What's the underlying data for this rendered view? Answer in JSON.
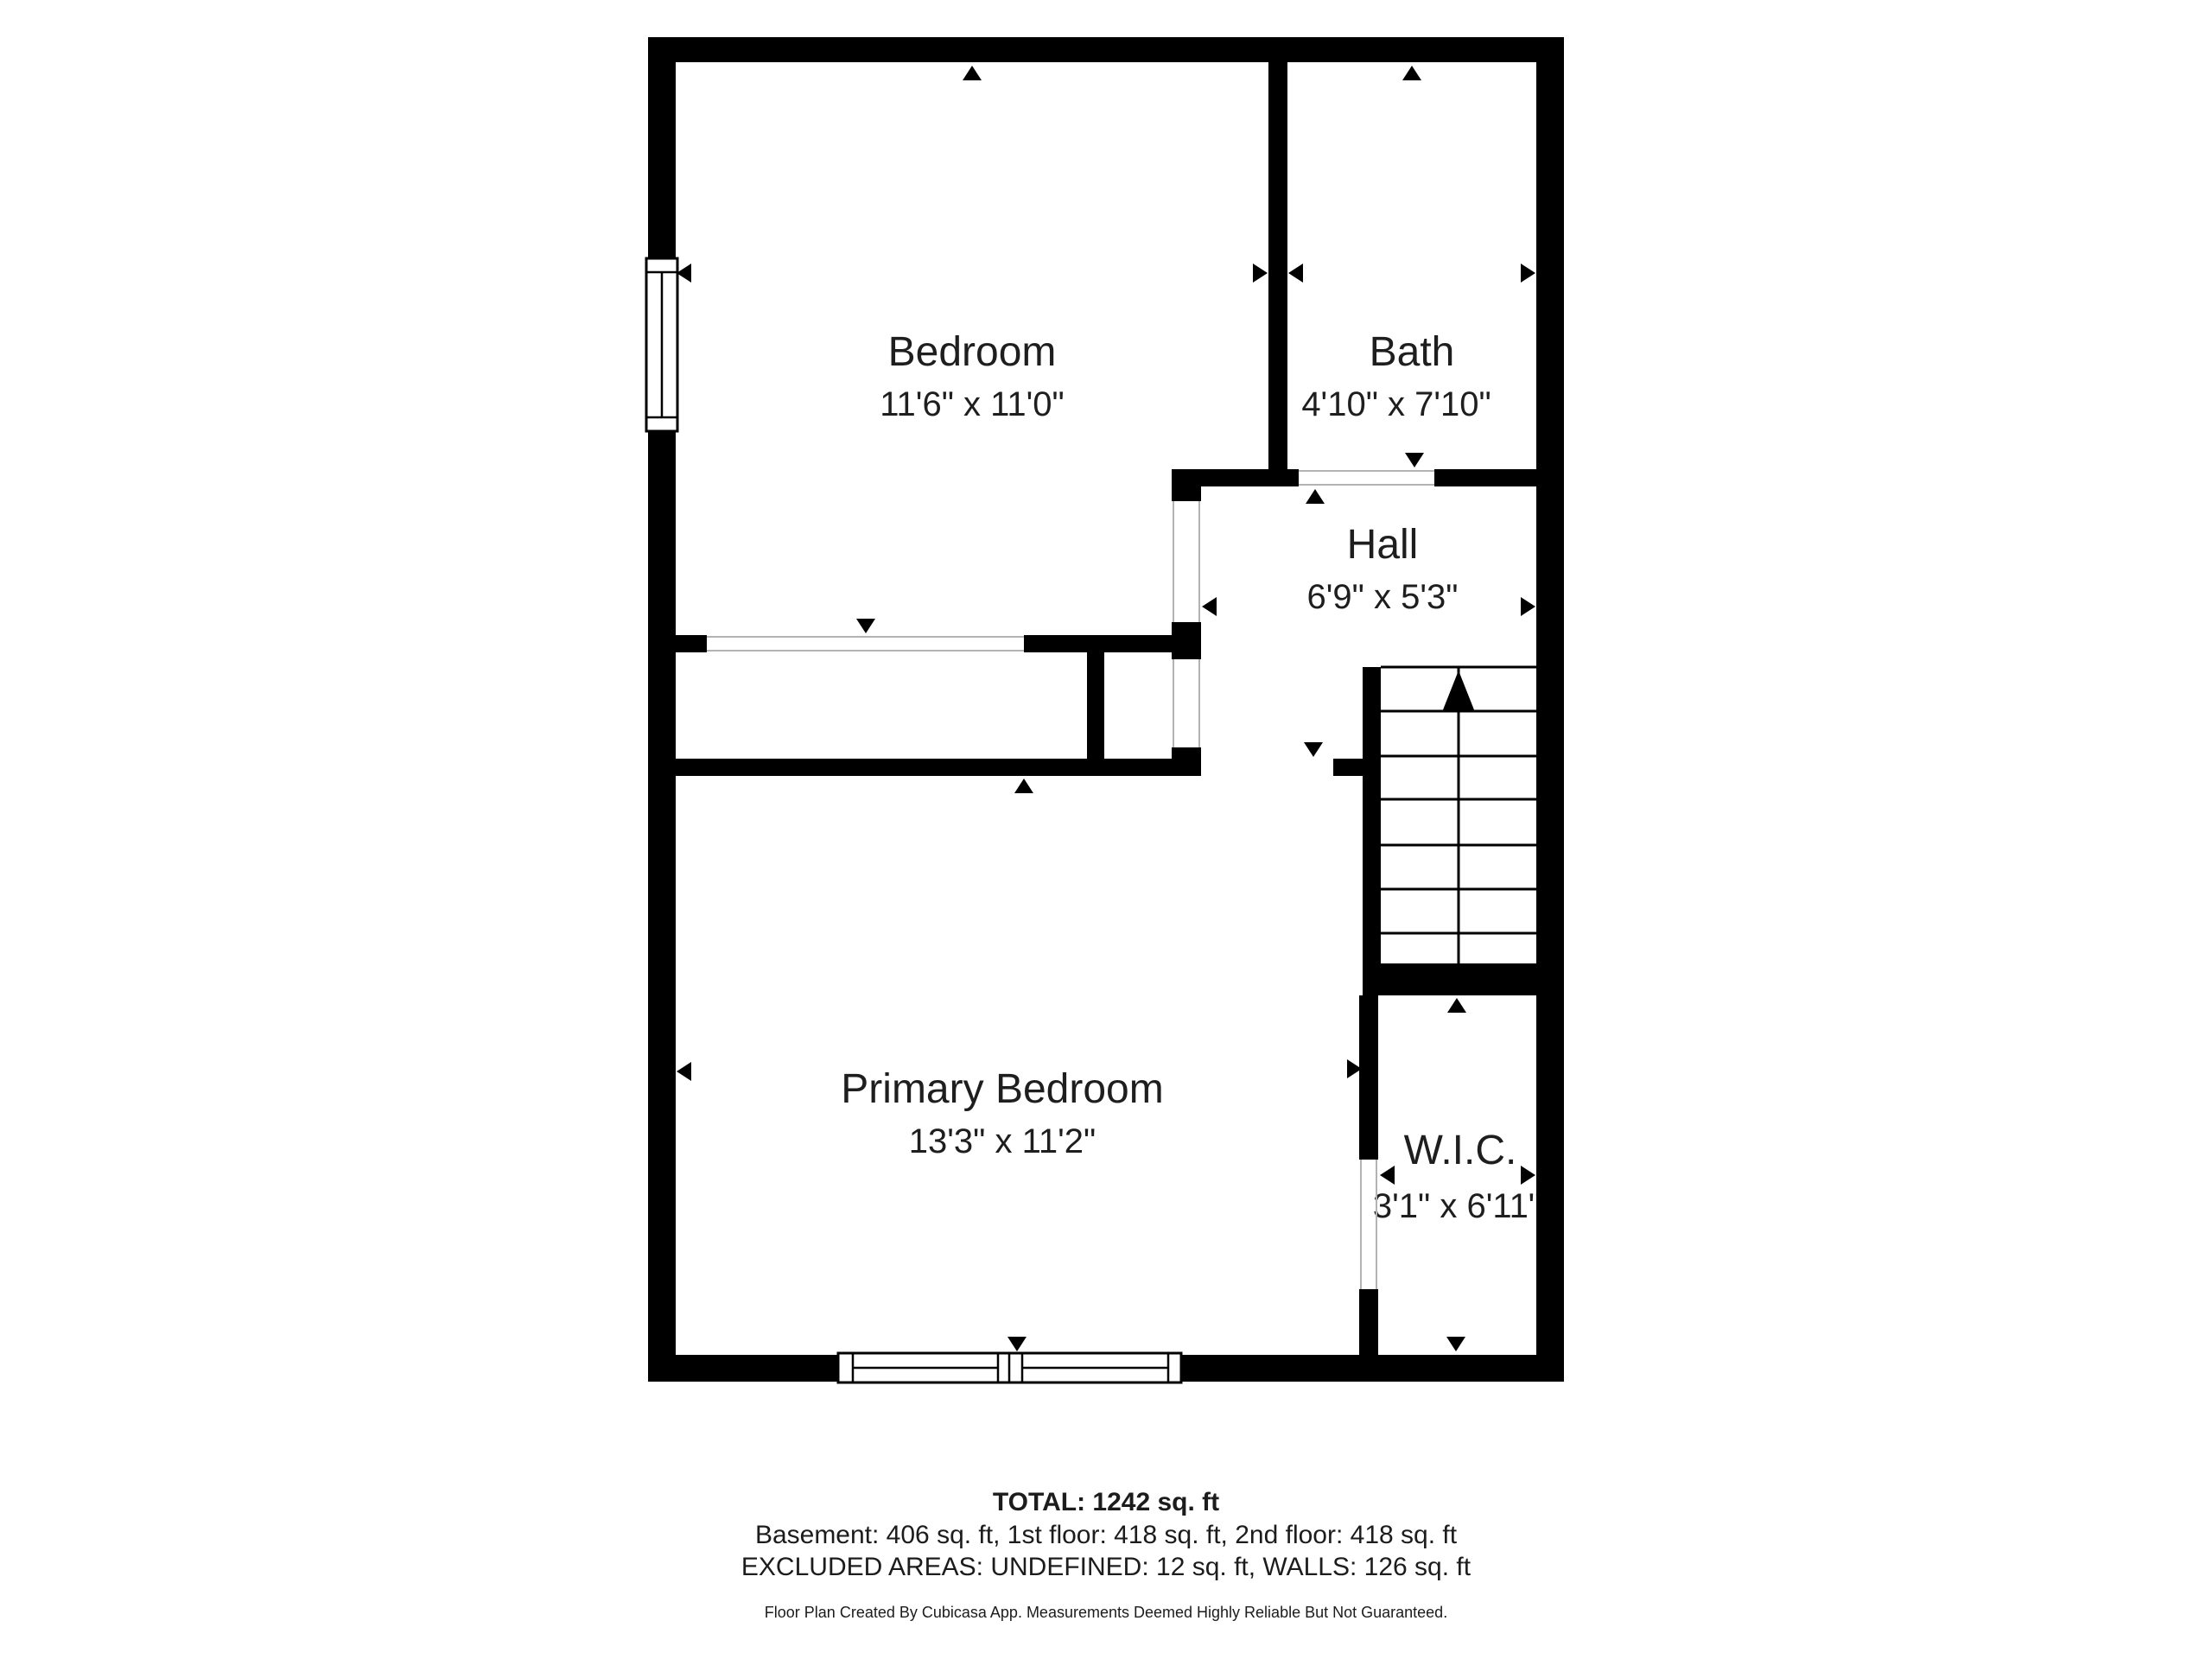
{
  "plan": {
    "rooms": [
      {
        "name": "Bedroom",
        "dims": "11'6\" x 11'0\""
      },
      {
        "name": "Bath",
        "dims": "4'10\" x 7'10\""
      },
      {
        "name": "Hall",
        "dims": "6'9\" x 5'3\""
      },
      {
        "name": "Primary Bedroom",
        "dims": "13'3\" x 11'2\""
      },
      {
        "name": "W.I.C.",
        "dims": "3'1\" x 6'11\""
      }
    ],
    "stairs_direction": "up"
  },
  "summary": {
    "total": "TOTAL: 1242 sq. ft",
    "floors": "Basement: 406 sq. ft, 1st floor: 418 sq. ft, 2nd floor: 418 sq. ft",
    "excluded": "EXCLUDED AREAS: UNDEFINED: 12 sq. ft, WALLS: 126 sq. ft",
    "disclaimer": "Floor Plan Created By Cubicasa App. Measurements Deemed Highly Reliable But Not Guaranteed."
  },
  "colors": {
    "wall": "#000000",
    "text": "#1e1e1e",
    "door_line": "#b3b3b3",
    "background": "#ffffff"
  }
}
